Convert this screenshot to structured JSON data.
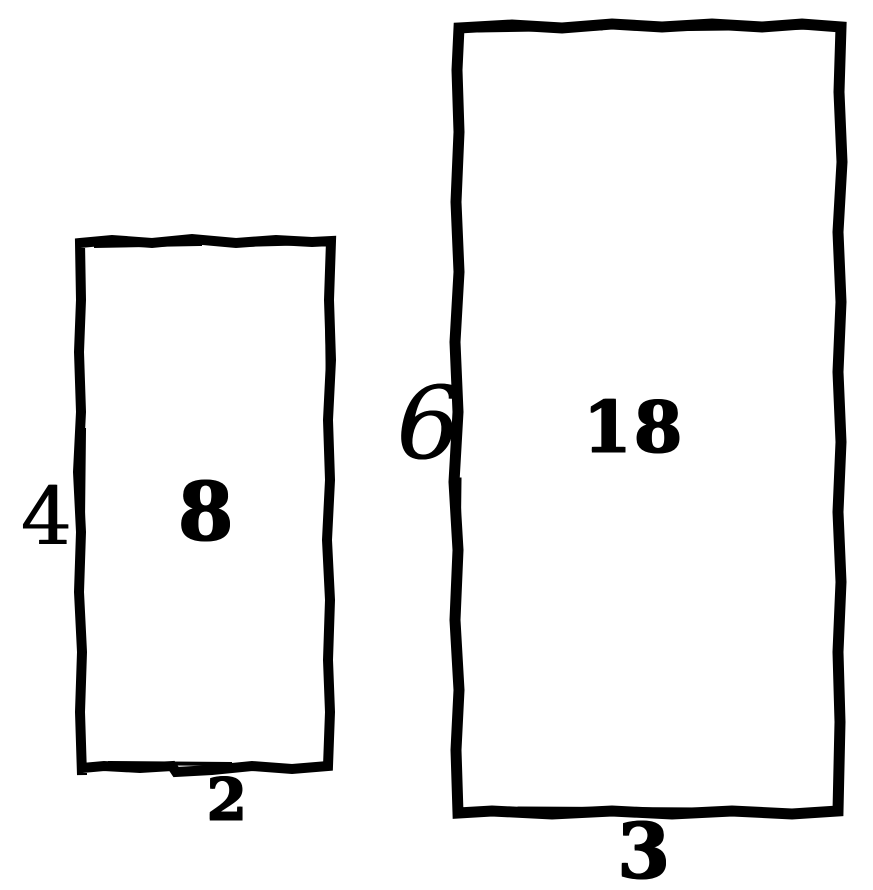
{
  "figure": {
    "ink_color": "#000000",
    "paper_color": "#ffffff",
    "rectangles": [
      {
        "id": "small-rectangle",
        "side_label": "4",
        "base_label": "2",
        "area_label": "8"
      },
      {
        "id": "large-rectangle",
        "side_label": "6",
        "base_label": "3",
        "area_label": "18"
      }
    ]
  }
}
